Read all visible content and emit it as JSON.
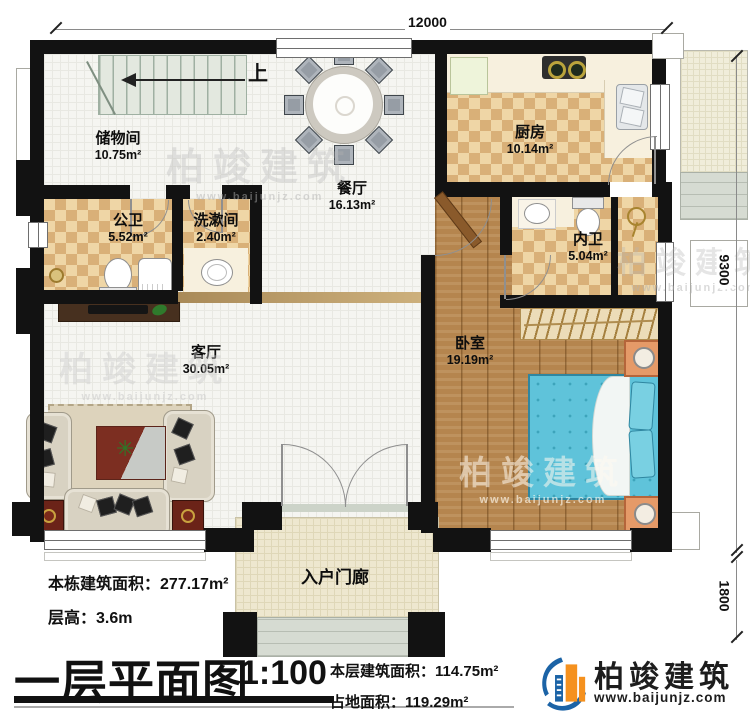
{
  "dims": {
    "width": "12000",
    "height": "9300",
    "porch": "1800"
  },
  "stairs": {
    "up": "上"
  },
  "rooms": {
    "storage": {
      "name": "储物间",
      "area": "10.75m²"
    },
    "public_bath": {
      "name": "公卫",
      "area": "5.52m²"
    },
    "washroom": {
      "name": "洗漱间",
      "area": "2.40m²"
    },
    "dining": {
      "name": "餐厅",
      "area": "16.13m²"
    },
    "kitchen": {
      "name": "厨房",
      "area": "10.14m²"
    },
    "ensuite": {
      "name": "内卫",
      "area": "5.04m²"
    },
    "bedroom": {
      "name": "卧室",
      "area": "19.19m²"
    },
    "living": {
      "name": "客厅",
      "area": "30.05m²"
    },
    "porch": {
      "name": "入户门廊"
    }
  },
  "title_block": {
    "title": "一层平面图",
    "scale": "1:100",
    "stats": {
      "building_total_label": "本栋建筑面积：",
      "building_total_value": "277.17m²",
      "floor_height_label": "层高：",
      "floor_height_value": "3.6m",
      "floor_area_label": "本层建筑面积：",
      "floor_area_value": "114.75m²",
      "footprint_label": "占地面积：",
      "footprint_value": "119.29m²"
    }
  },
  "brand": {
    "name": "柏竣建筑",
    "site": "www.baijunjz.com"
  },
  "colors": {
    "wall": "#121212",
    "checker_dark": "#d9b078",
    "checker_light": "#efd6a6",
    "wood": "#b5854e",
    "bed_blue": "#5fc3da",
    "nightstand_orange": "#e59a68",
    "logo_blue": "#1b63a6",
    "logo_orange": "#f5911e"
  }
}
